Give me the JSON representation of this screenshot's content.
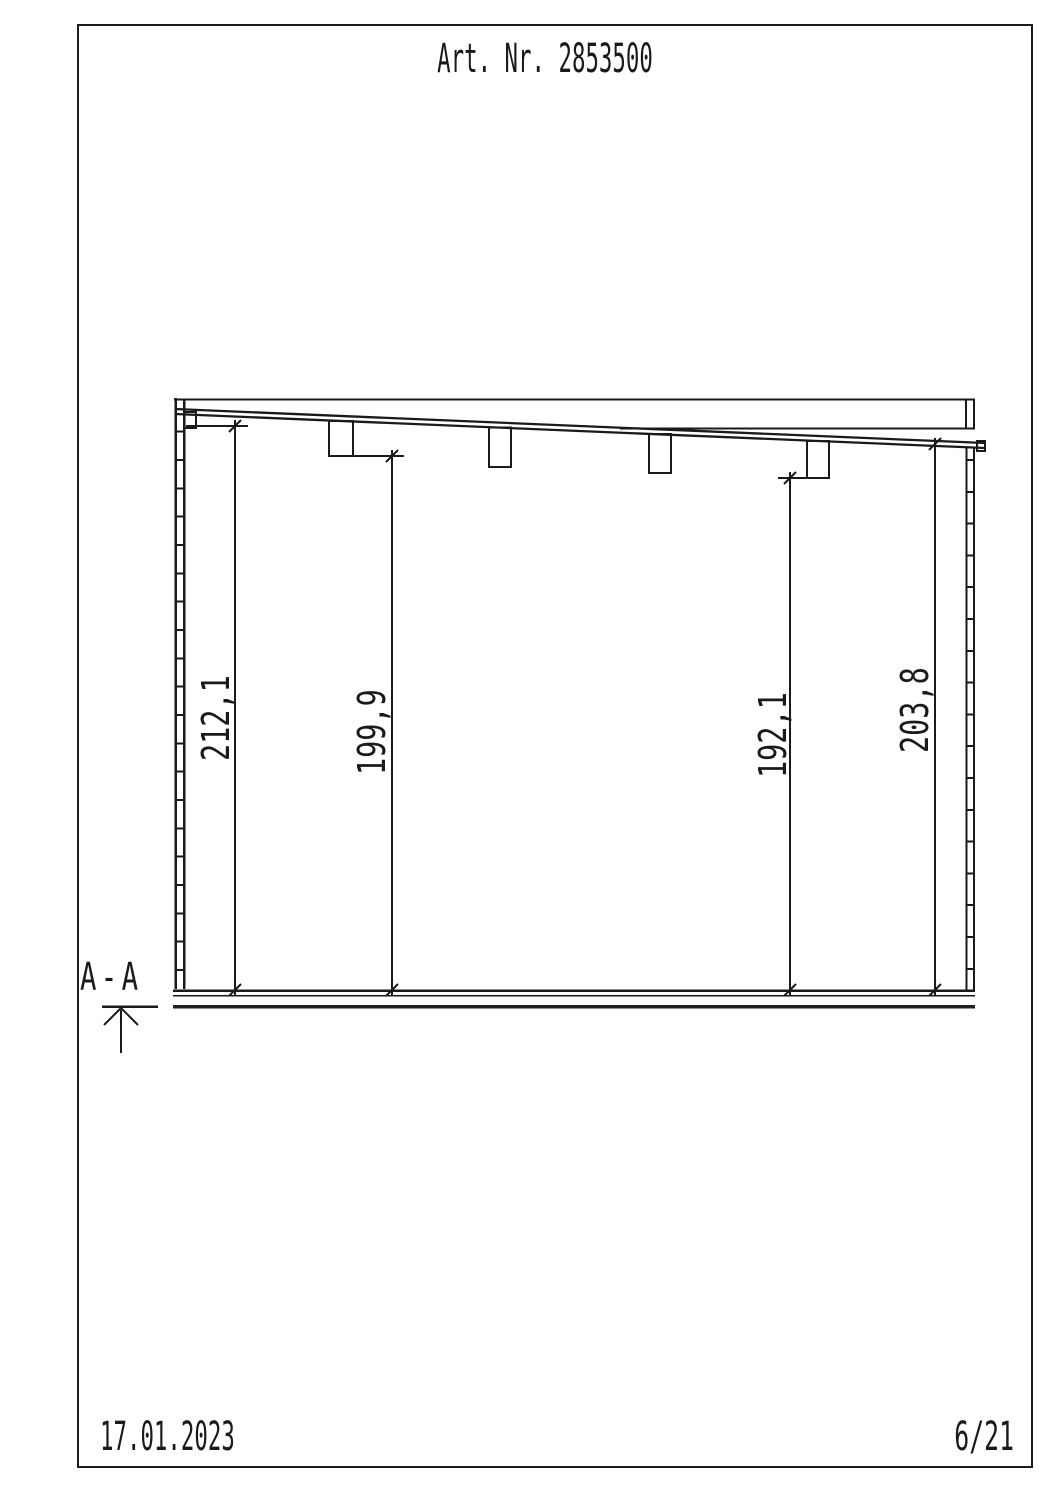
{
  "page": {
    "title": "Art. Nr. 2853500",
    "date": "17.01.2023",
    "page_number": "6/21",
    "section_label": "A-A"
  },
  "dimensions": [
    {
      "label": "212,1"
    },
    {
      "label": "199,9"
    },
    {
      "label": "192,1"
    },
    {
      "label": "203,8"
    }
  ]
}
